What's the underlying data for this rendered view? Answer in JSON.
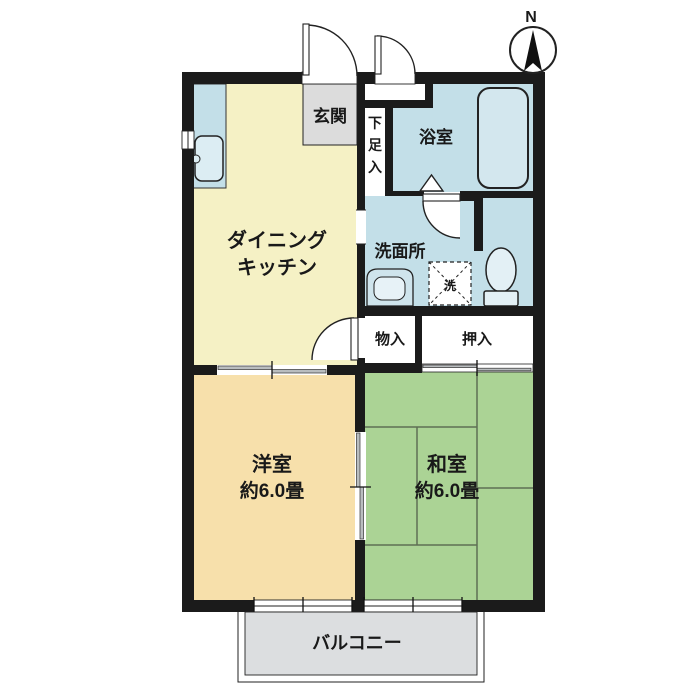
{
  "floorplan": {
    "compass": "N",
    "rooms": {
      "dining_kitchen": {
        "line1": "ダイニング",
        "line2": "キッチン"
      },
      "western_room": {
        "name": "洋室",
        "size": "約6.0畳"
      },
      "japanese_room": {
        "name": "和室",
        "size": "約6.0畳"
      },
      "entrance": {
        "name": "玄関"
      },
      "bathroom": {
        "name": "浴室"
      },
      "washroom": {
        "name": "洗面所"
      },
      "shoe_cabinet": {
        "name": "下足入",
        "chars": [
          "下",
          "足",
          "入"
        ]
      },
      "storage": {
        "name": "物入"
      },
      "closet": {
        "name": "押入"
      },
      "balcony": {
        "name": "バルコニー"
      },
      "laundry": {
        "name": "洗"
      }
    },
    "colors": {
      "wall": "#1b1b1b",
      "dining_kitchen": "#f5f1c5",
      "western_room": "#f7e0ab",
      "japanese_room": "#abd395",
      "wet_area": "#c3dfe8",
      "entrance": "#dcdcdc",
      "balcony": "#dcdee0",
      "bathtub": "#d3e7ee"
    }
  }
}
